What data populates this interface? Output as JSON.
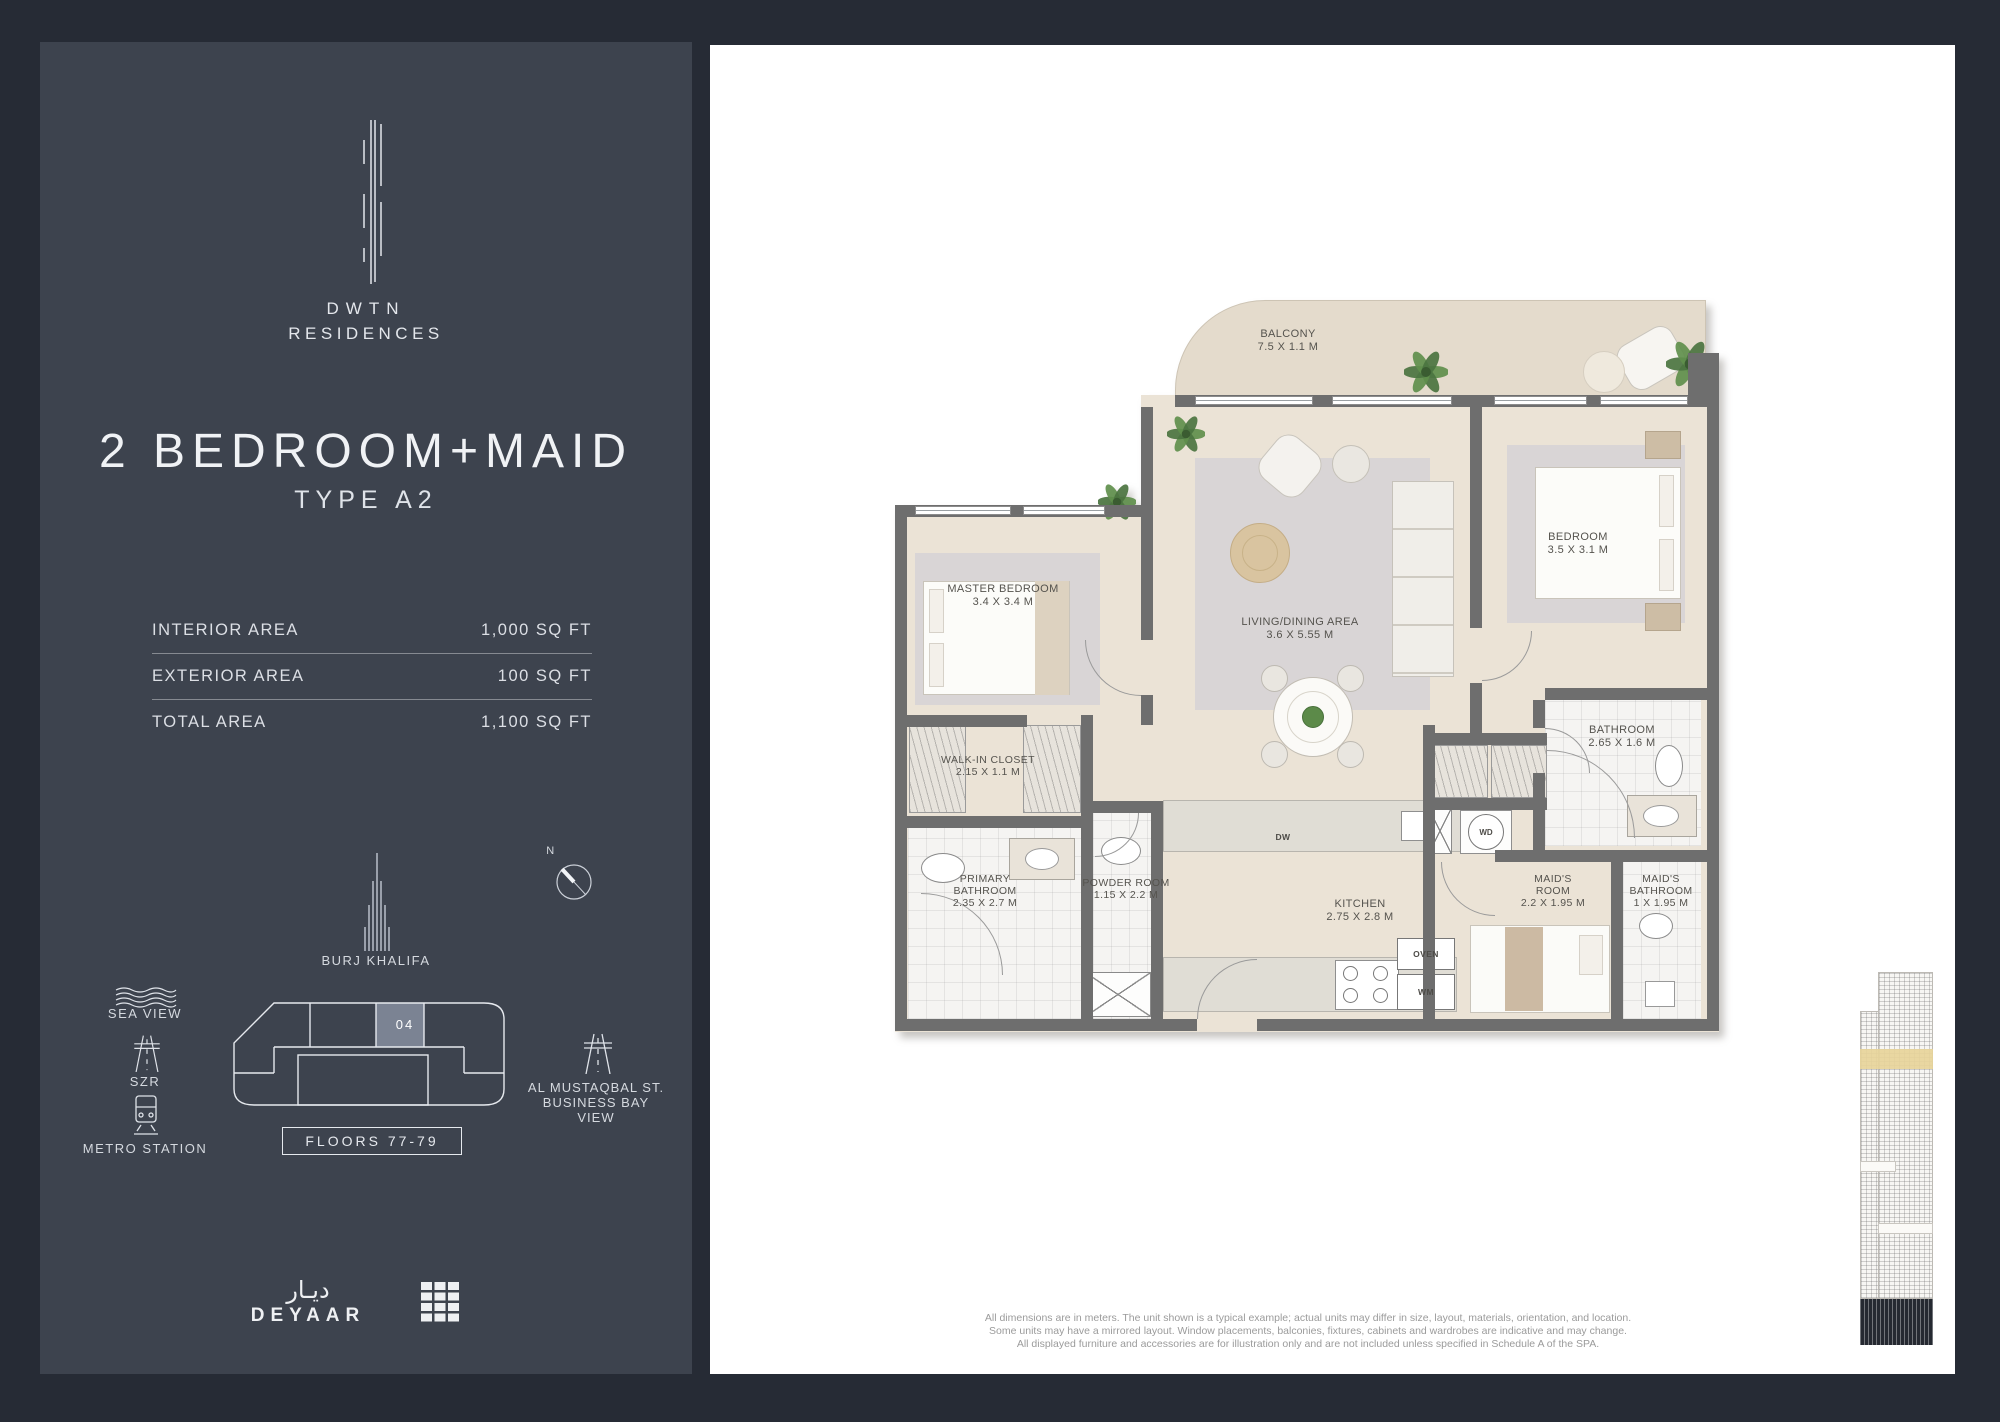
{
  "colors": {
    "page_bg": "#262b35",
    "sidebar_bg": "#3d434e",
    "panel_bg": "#ffffff",
    "wall": "#6e6e6e",
    "floor": "#ebe3d6",
    "unit_highlight": "#7b8393",
    "elevation_band": "#e7d49a"
  },
  "sidebar": {
    "brand": {
      "line1": "DWTN",
      "line2": "RESIDENCES"
    },
    "title": "2 BEDROOM+MAID",
    "subtitle": "TYPE A2",
    "areas": [
      {
        "label": "INTERIOR AREA",
        "value": "1,000 SQ FT"
      },
      {
        "label": "EXTERIOR AREA",
        "value": "100 SQ FT"
      },
      {
        "label": "TOTAL AREA",
        "value": "1,100 SQ FT"
      }
    ],
    "burj_label": "BURJ KHALIFA",
    "compass_n": "N",
    "sea_view_label": "SEA VIEW",
    "szr_label": "SZR",
    "metro_label": "METRO STATION",
    "street_lines": [
      "AL MUSTAQBAL ST.",
      "BUSINESS BAY",
      "VIEW"
    ],
    "floorplate": {
      "unit": "04",
      "floors": "FLOORS 77-79"
    },
    "developer": {
      "arabic": "ديـار",
      "latin": "DEYAAR"
    }
  },
  "plan": {
    "rooms": [
      {
        "id": "balcony",
        "name": "BALCONY",
        "dims": "7.5 X 1.1 M"
      },
      {
        "id": "master-bedroom",
        "name": "MASTER BEDROOM",
        "dims": "3.4 X 3.4 M"
      },
      {
        "id": "living-dining",
        "name": "LIVING/DINING AREA",
        "dims": "3.6 X 5.55 M"
      },
      {
        "id": "bedroom",
        "name": "BEDROOM",
        "dims": "3.5 X 3.1 M"
      },
      {
        "id": "walk-in-closet",
        "name": "WALK-IN CLOSET",
        "dims": "2.15 X 1.1 M"
      },
      {
        "id": "bathroom",
        "name": "BATHROOM",
        "dims": "2.65 X 1.6 M"
      },
      {
        "id": "primary-bathroom",
        "name": "PRIMARY BATHROOM",
        "dims": "2.35 X 2.7 M"
      },
      {
        "id": "powder-room",
        "name": "POWDER ROOM",
        "dims": "1.15 X 2.2 M"
      },
      {
        "id": "kitchen",
        "name": "KITCHEN",
        "dims": "2.75 X 2.8 M"
      },
      {
        "id": "maids-room",
        "name": "MAID'S ROOM",
        "dims": "2.2 X 1.95 M"
      },
      {
        "id": "maids-bathroom",
        "name": "MAID'S BATHROOM",
        "dims": "1 X 1.95 M"
      }
    ],
    "appliances": {
      "dw": "DW",
      "oven": "OVEN",
      "wm": "WM",
      "wd": "WD"
    }
  },
  "disclaimer": {
    "line1": "All dimensions are in meters. The unit shown is a typical example; actual units may differ in size, layout, materials, orientation, and location.",
    "line2": "Some units may have a mirrored layout. Window placements, balconies, fixtures, cabinets and wardrobes are indicative and may change.",
    "line3": "All displayed furniture and accessories are for illustration only and are not included unless specified in Schedule A of the SPA."
  }
}
